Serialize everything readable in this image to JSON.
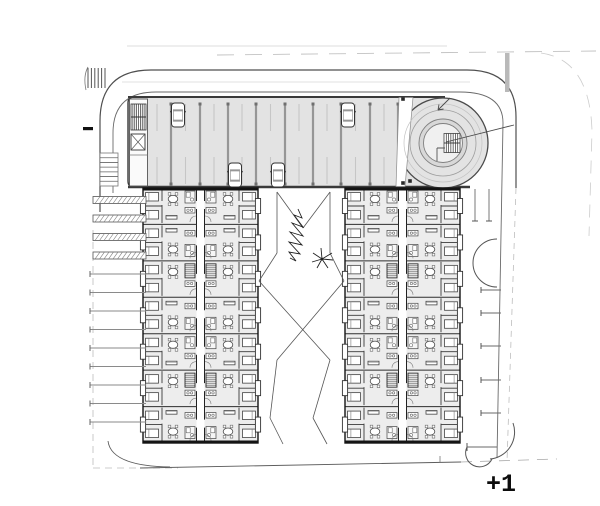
{
  "label": {
    "floor_level": "+1"
  },
  "colors": {
    "bg": "#ffffff",
    "deck_fill": "#e3e3e3",
    "building_fill": "#ededed",
    "wall": "#141414",
    "line_dark": "#4f4f4f",
    "line_mid": "#6a6a6a",
    "line_light": "#bdbdbd",
    "stall_bar": "#969696",
    "stall_cap": "#6f6f6f",
    "stall_tick": "#c6c6c6",
    "furniture": "#444444",
    "hatch": "#666666"
  },
  "plan": {
    "canvas": {
      "w": 600,
      "h": 506
    },
    "guides": [
      {
        "name": "boundary-top-faint",
        "d": "M127,46 H447",
        "w": 0.8,
        "c": "#d0d0d0"
      },
      {
        "name": "boundary-top-dashed",
        "d": "M217,55 L596,51",
        "w": 0.9,
        "c": "#c2c2c2",
        "dash": "17 11"
      },
      {
        "name": "road-top-lane-faint",
        "d": "M122,82 H470",
        "w": 0.7,
        "c": "#d9d9d9"
      },
      {
        "name": "road-top-outer",
        "d": "M100,212 V121 Q100,70 151,70 H467 Q516,70 516,117 V188",
        "w": 1.2,
        "c": "#4f4f4f"
      },
      {
        "name": "road-top-inner",
        "d": "M113,193 V133 Q113,92 156,92 H460 Q503,92 503,123 L497,458",
        "w": 0.9,
        "c": "#6a6a6a"
      },
      {
        "name": "road-right-outer-cont",
        "d": "M516,188 L507,462",
        "w": 0.8,
        "c": "#bdbdbd",
        "dash": "6 5"
      },
      {
        "name": "boundary-right-faint",
        "d": "M541,53 Q590,60 592,131 L589,236",
        "w": 0.8,
        "c": "#cccccc",
        "dash": "13 9"
      },
      {
        "name": "boundary-left-dashed",
        "d": "M93,230 V468",
        "w": 0.8,
        "c": "#bdbdbd",
        "dash": "7 5"
      },
      {
        "name": "boundary-bottom-dashed",
        "d": "M93,468 H178",
        "w": 0.8,
        "c": "#bdbdbd",
        "dash": "7 5"
      },
      {
        "name": "road-bottom",
        "d": "M140,468 L461,462",
        "w": 0.9,
        "c": "#5d5d5d"
      },
      {
        "name": "road-bottom-dashed-right",
        "d": "M461,462 L557,459",
        "w": 0.8,
        "c": "#a8a8a8",
        "dash": "11 8"
      },
      {
        "name": "corner-arc-bottom-left",
        "d": "M108,441 Q111,466 170,467",
        "w": 0.9,
        "c": "#5d5d5d"
      },
      {
        "name": "road-bottom-tick",
        "d": "M440,456 V463",
        "w": 0.8,
        "c": "#777777"
      }
    ],
    "median_bar": {
      "x": 505,
      "y": 53,
      "w": 4.5,
      "h": 39,
      "fill": "#b9b9b9"
    },
    "crosswalk": {
      "x": 88,
      "y": 68,
      "lines": 6,
      "step": 3.4,
      "h": 20
    },
    "ramp_hatch": {
      "x": 100,
      "y": 153,
      "w": 18,
      "h": 33,
      "lines": 7
    },
    "black_tick": {
      "x": 83,
      "y": 127,
      "w": 10,
      "h": 3.2
    },
    "deck": {
      "x": 128,
      "y": 97,
      "w": 317,
      "h": 90,
      "stall_xs": [
        171,
        200,
        228,
        256,
        285,
        313,
        341,
        370,
        398
      ],
      "tick_xs": [
        157,
        185.5,
        214,
        242,
        270.5,
        299,
        327,
        355.5,
        384
      ],
      "bar_y1": 104,
      "bar_y2": 184,
      "tick_rows": [
        [
          104,
          131
        ],
        [
          157,
          184
        ]
      ],
      "cars": [
        {
          "x": 178,
          "y": 115
        },
        {
          "x": 348,
          "y": 115
        },
        {
          "x": 235,
          "y": 175
        },
        {
          "x": 278,
          "y": 175
        }
      ],
      "columns": [
        [
          410,
          104
        ],
        [
          410,
          181
        ]
      ],
      "vestibule": {
        "x": 129.5,
        "y": 99,
        "w": 18,
        "h": 87,
        "stair": {
          "x": 131,
          "y": 104,
          "w": 15,
          "h": 26
        },
        "lift": {
          "x": 131,
          "y": 134,
          "w": 14,
          "h": 16
        }
      }
    },
    "ramp": {
      "cx": 443,
      "cy": 143,
      "r_outer": 45,
      "r_guide1": 39,
      "r_guide2": 33,
      "r_ring": 24,
      "r_core": 19.5,
      "wedge": "M399,97.5 L413,97.5 L405,186.5 L396,186.5 Z",
      "stairs": {
        "x": 444,
        "y": 133.5,
        "w": 16,
        "h": 19,
        "lines": 7
      },
      "core_wall": "M437,148 h8 M437,148 v13",
      "radial": "M446,142 L514,125",
      "arrow": "M450,98 L438,110 M438,110 l5.5,-1 M438,110 l1,-5.5",
      "dots": [
        [
          403,
          99
        ],
        [
          403,
          183
        ]
      ]
    },
    "buildings": {
      "y": 188,
      "w": 115,
      "h": 255,
      "rows": 7,
      "xs": [
        143,
        345
      ],
      "variants": [
        "A",
        "B",
        "C",
        "B",
        "A",
        "C",
        "B"
      ]
    },
    "left_parking": {
      "x1": 90,
      "x2": 146,
      "y_start": 200,
      "step": 18.5,
      "count": 13,
      "hatched": 4
    },
    "right_parking": {
      "divider_ys": [
        290,
        313,
        346,
        380,
        413
      ],
      "x1": 481,
      "x2": 501,
      "top_stall_xs": [
        475,
        489
      ],
      "top_stall_y1": 189,
      "top_stall_y2": 221,
      "arcs": [
        "M497,239 A24,24 0 0 0 497,287",
        "M513,423 A27,27 0 0 1 490,459",
        "M467,447 A13,13 0 0 0 492,459"
      ],
      "low_divider": "M467,447 H497",
      "low_cap": "M467,443 V451"
    },
    "courtyard": {
      "segments": [
        [
          277,
          192,
          277,
          253
        ],
        [
          330,
          192,
          330,
          253
        ],
        [
          277,
          192,
          303,
          228
        ],
        [
          330,
          192,
          303,
          228
        ],
        [
          277,
          253,
          259,
          281
        ],
        [
          330,
          253,
          344,
          281
        ],
        [
          259,
          281,
          330,
          360
        ],
        [
          344,
          281,
          277,
          360
        ],
        [
          277,
          360,
          270,
          418
        ],
        [
          330,
          360,
          313,
          418
        ],
        [
          270,
          418,
          283,
          444
        ],
        [
          313,
          418,
          327,
          444
        ]
      ],
      "tree_cypress": "M298,209 l4,9 l-8,-3 l9,12 l-11,-4 l11,13 l-13,-4 l12,13 l-13,-3 l11,12 l-11,-2 l7,9 l-6,-3",
      "tree_palm": "M322,259 l10,-6 M322,259 l11,1 M322,259 l6,9 M322,259 l-5,9 M322,259 l-10,3 M322,259 l-9,-6 M322,259 l-1,-11",
      "palm_center": [
        322,
        259
      ]
    }
  }
}
